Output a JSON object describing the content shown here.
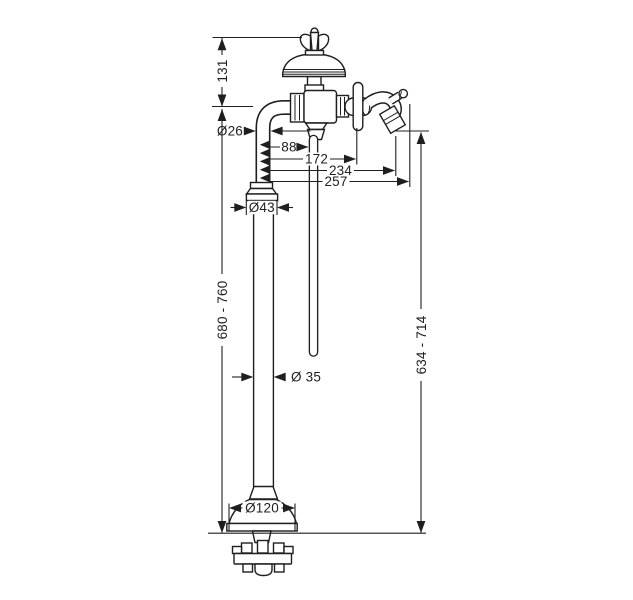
{
  "drawing_title": "freestanding bath mixer - dimensional drawing",
  "dimensions": {
    "handle_to_body_height": "131",
    "riser_pipe_diameter": "Ø26",
    "dip_tube_offset": "88",
    "handle_offset": "172",
    "spout_outlet_offset": "234",
    "spout_tip_offset": "257",
    "base_collar_diameter": "Ø43",
    "overall_height_range": "680 - 760",
    "column_diameter": "Ø 35",
    "outlet_height_range": "634 - 714",
    "base_plate_diameter": "Ø120"
  },
  "colors": {
    "line": "#1f1f1f",
    "background": "#ffffff"
  }
}
